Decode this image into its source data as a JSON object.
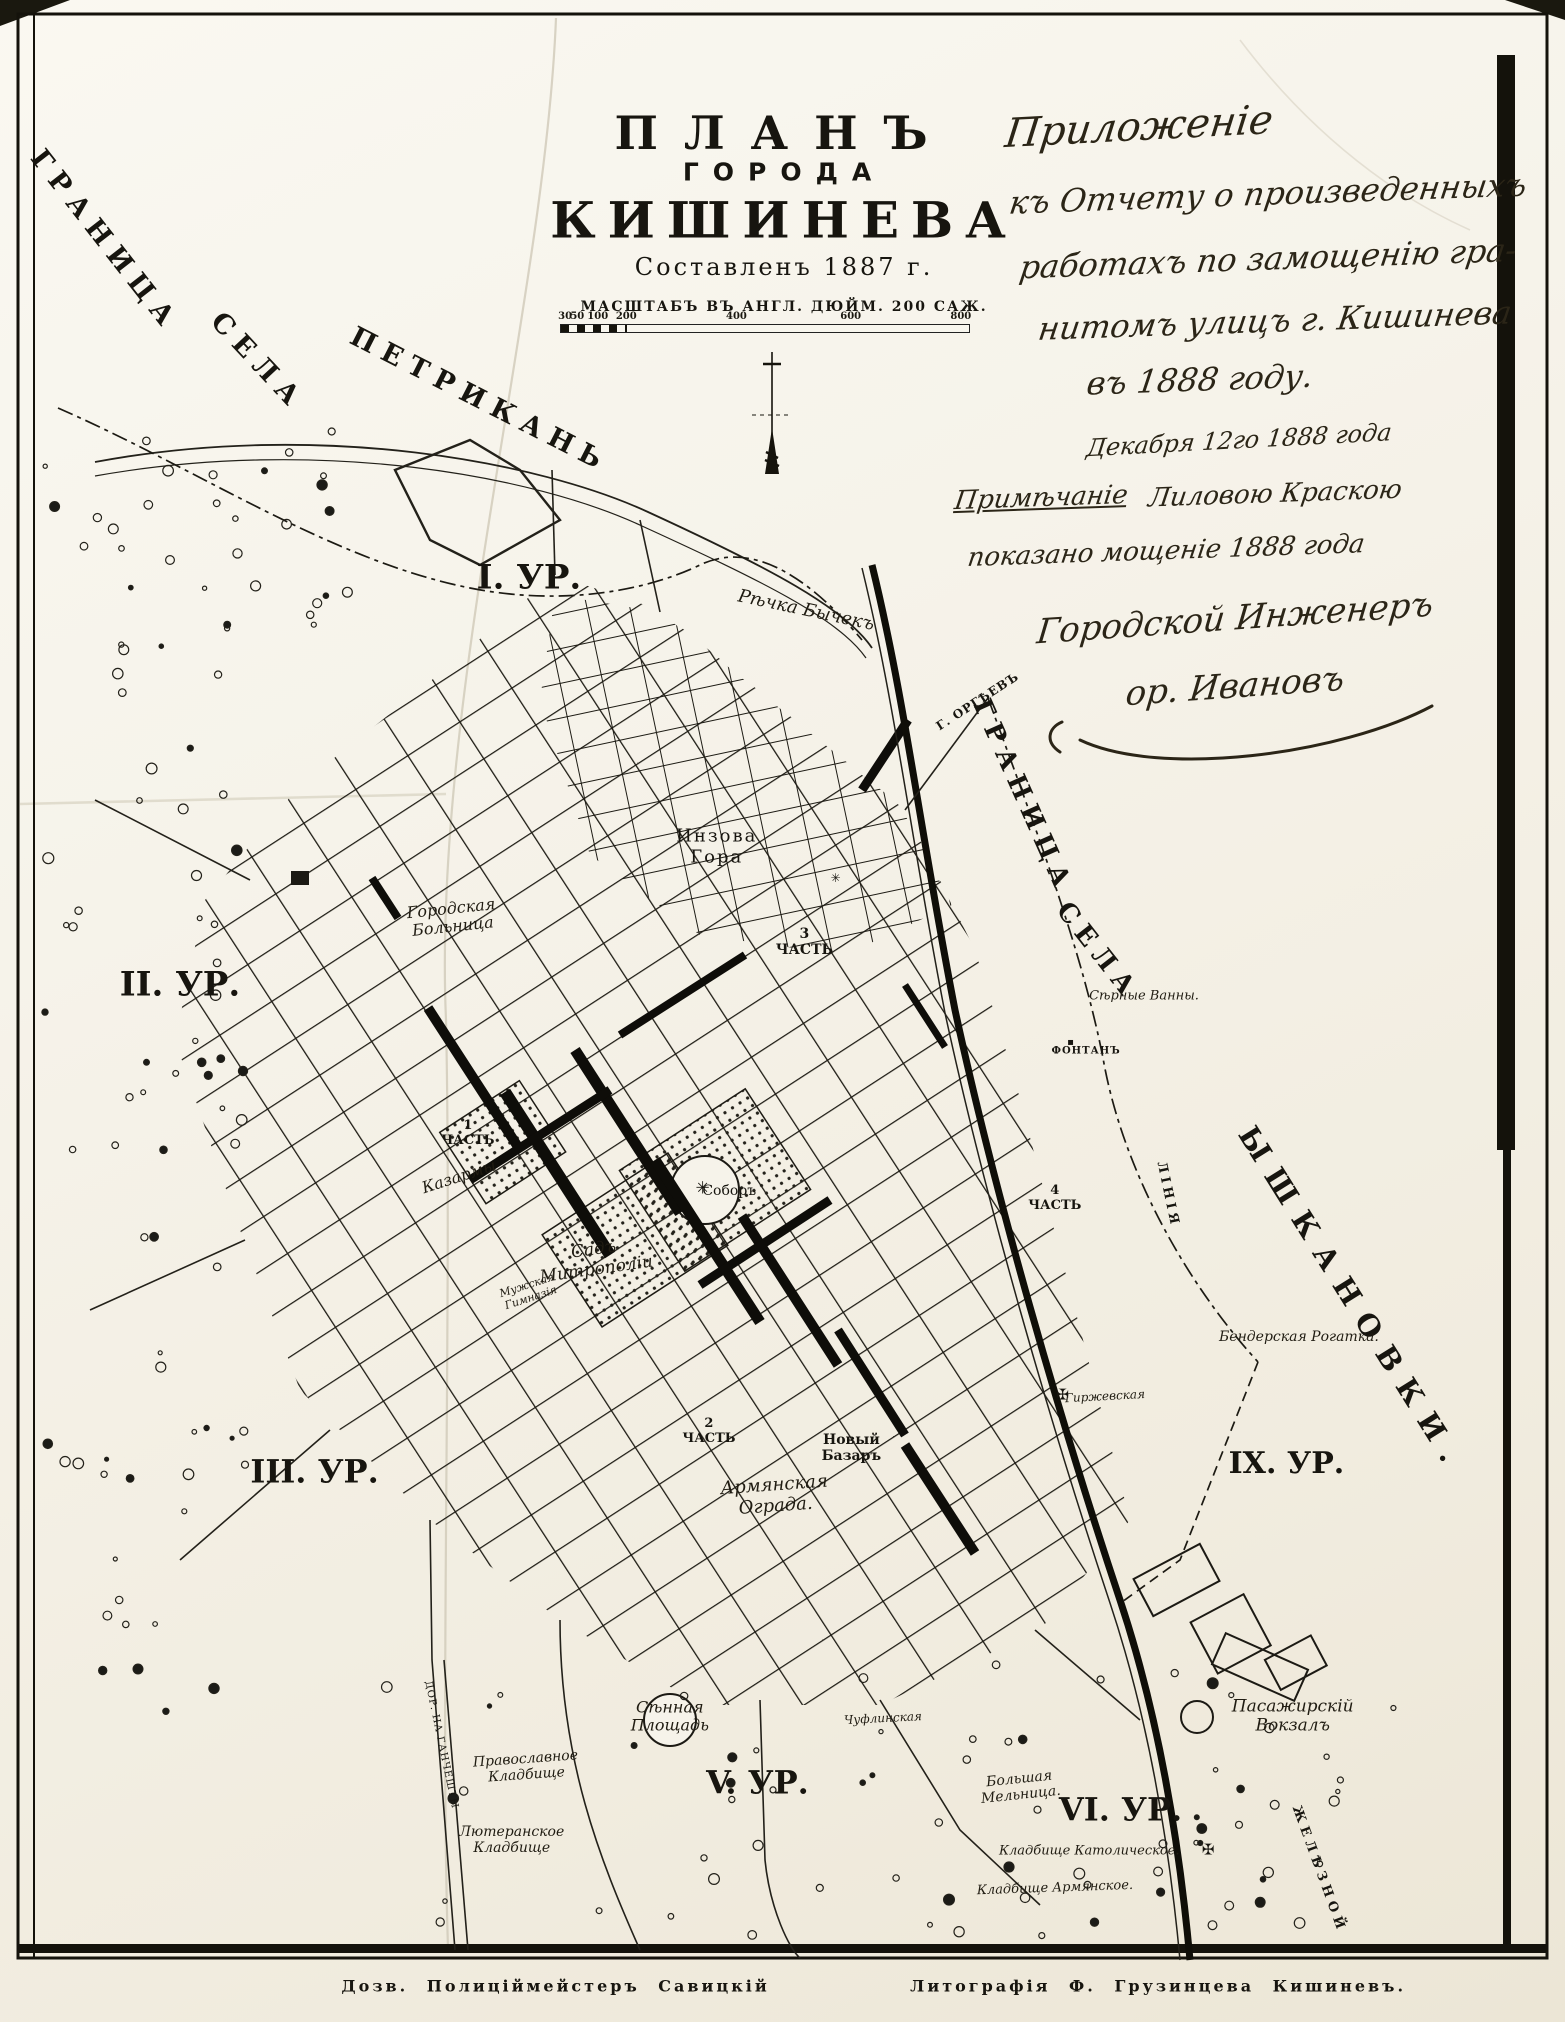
{
  "title_block": {
    "line1": "ПЛАНЪ",
    "line2": "ГОРОДА",
    "line3": "КИШИНЕВА",
    "line4": "Составленъ 1887 г.",
    "scale_text": "МАСШТАБЪ ВЪ АНГЛ. ДЮЙМ. 200 САЖ.",
    "scale_ticks": [
      {
        "t": "30",
        "f": 1
      },
      {
        "t": "50",
        "f": 4
      },
      {
        "t": "100",
        "f": 9
      },
      {
        "t": "200",
        "f": 16
      },
      {
        "t": "400",
        "f": 43
      },
      {
        "t": "600",
        "f": 71
      },
      {
        "t": "800",
        "f": 98
      }
    ]
  },
  "annotation": {
    "lines": [
      {
        "name": "hw-prilozhenie",
        "text": "Приложеніе",
        "x": 72.8,
        "y": 6.3,
        "fs": 40,
        "rot": -3
      },
      {
        "name": "hw-k-otchetu",
        "text": "къ Отчету о произведенныхъ",
        "x": 81.0,
        "y": 9.6,
        "fs": 32,
        "rot": -2
      },
      {
        "name": "hw-rabotakh",
        "text": "работахъ по замощенію гра-",
        "x": 81.0,
        "y": 12.8,
        "fs": 32,
        "rot": -2
      },
      {
        "name": "hw-nitom",
        "text": "нитомъ улицъ г. Кишинева",
        "x": 81.5,
        "y": 15.9,
        "fs": 32,
        "rot": -2
      },
      {
        "name": "hw-v-1888",
        "text": "въ 1888 году.",
        "x": 76.7,
        "y": 18.8,
        "fs": 32,
        "rot": -2
      },
      {
        "name": "hw-date",
        "text": "Декабря 12го 1888 года",
        "x": 79.2,
        "y": 21.8,
        "fs": 24,
        "rot": -3
      },
      {
        "name": "hw-primechanie",
        "text": "Примѣчаніе",
        "x": 66.5,
        "y": 24.7,
        "fs": 26,
        "rot": -2,
        "u": true
      },
      {
        "name": "hw-lilovoyu",
        "text": "Лиловою Краскою",
        "x": 81.5,
        "y": 24.5,
        "fs": 26,
        "rot": -2
      },
      {
        "name": "hw-pokazano",
        "text": "показано мощеніе 1888 года",
        "x": 74.5,
        "y": 27.3,
        "fs": 26,
        "rot": -2
      },
      {
        "name": "hw-gorodskoy-inzhener",
        "text": "Городской Инженеръ",
        "x": 78.9,
        "y": 30.6,
        "fs": 34,
        "rot": -4
      },
      {
        "name": "hw-signature",
        "text": "ор. Ивановъ",
        "x": 78.9,
        "y": 34.0,
        "fs": 34,
        "rot": -4
      }
    ]
  },
  "map": {
    "labels": [
      {
        "name": "label-granitsa-petrikan-1",
        "text": "ГРАНИЦА",
        "x": 6.7,
        "y": 11.9,
        "rot": 52,
        "fs": 27,
        "ls": 9,
        "b": true
      },
      {
        "name": "label-granitsa-petrikan-2",
        "text": "СЕЛА",
        "x": 16.5,
        "y": 17.9,
        "rot": 47,
        "fs": 27,
        "ls": 9,
        "b": true
      },
      {
        "name": "label-granitsa-petrikan-3",
        "text": "ПЕТРИКАНЬ",
        "x": 30.7,
        "y": 19.8,
        "rot": 27,
        "fs": 27,
        "ls": 9,
        "b": true
      },
      {
        "name": "label-granitsa-sela-1",
        "text": "ГРАНИЦА",
        "x": 65.3,
        "y": 39.4,
        "rot": 66,
        "fs": 26,
        "ls": 8,
        "b": true
      },
      {
        "name": "label-granitsa-sela-2",
        "text": "СЕЛА",
        "x": 70.1,
        "y": 47.1,
        "rot": 52,
        "fs": 26,
        "ls": 8,
        "b": true
      },
      {
        "name": "label-yshkanovki",
        "text": "ЫШКАНОВКИ.",
        "x": 86.4,
        "y": 64.3,
        "rot": 58,
        "fs": 29,
        "ls": 14,
        "b": true
      },
      {
        "name": "label-rechka-bychek",
        "text": "Рѣчка Бычекъ",
        "x": 51.5,
        "y": 30.2,
        "rot": 12,
        "fs": 18,
        "i": true
      },
      {
        "name": "label-g-orgeyev",
        "text": "Г. ОРГѢЕВЪ",
        "x": 62.5,
        "y": 34.7,
        "rot": -33,
        "fs": 12,
        "ls": 1,
        "b": true
      },
      {
        "name": "label-district-1",
        "text": "I. УР.",
        "x": 33.8,
        "y": 28.6,
        "fs": 34,
        "b": true
      },
      {
        "name": "label-district-2",
        "text": "II. УР.",
        "x": 11.5,
        "y": 48.7,
        "fs": 34,
        "b": true
      },
      {
        "name": "label-district-3",
        "text": "III. УР.",
        "x": 20.1,
        "y": 72.8,
        "fs": 32,
        "b": true
      },
      {
        "name": "label-district-5",
        "text": "V. УР.",
        "x": 48.4,
        "y": 88.2,
        "fs": 32,
        "b": true
      },
      {
        "name": "label-district-6",
        "text": "VI. УР.",
        "x": 71.6,
        "y": 89.5,
        "fs": 32,
        "b": true
      },
      {
        "name": "label-district-9",
        "text": "IX. УР.",
        "x": 82.2,
        "y": 72.4,
        "fs": 30,
        "b": true
      },
      {
        "name": "label-inzova-gora",
        "text": "Инзова\nГора",
        "x": 45.8,
        "y": 41.9,
        "fs": 18,
        "ls": 2
      },
      {
        "name": "label-3-chast",
        "text": "3\nЧАСТЬ",
        "x": 51.4,
        "y": 46.6,
        "fs": 14,
        "b": true
      },
      {
        "name": "label-1-chast",
        "text": "1\nЧАСТЬ",
        "x": 29.9,
        "y": 56.1,
        "fs": 13,
        "b": true
      },
      {
        "name": "label-2-chast",
        "text": "2\nЧАСТЬ",
        "x": 45.3,
        "y": 70.8,
        "fs": 13,
        "b": true
      },
      {
        "name": "label-4-chast",
        "text": "4\nЧАСТЬ",
        "x": 67.4,
        "y": 59.3,
        "fs": 13,
        "b": true
      },
      {
        "name": "label-gorodskaya-bolnitsa",
        "text": "Городская\nБольница",
        "x": 28.9,
        "y": 45.4,
        "rot": -6,
        "fs": 16,
        "i": true
      },
      {
        "name": "label-kazarmy",
        "text": "Казармы",
        "x": 29.3,
        "y": 58.2,
        "rot": -18,
        "fs": 16,
        "i": true
      },
      {
        "name": "label-sobor",
        "text": "Соборъ",
        "x": 46.6,
        "y": 58.9,
        "fs": 14
      },
      {
        "name": "label-sad-mitropolii",
        "text": "Садъ\nМитрополіи",
        "x": 38.0,
        "y": 62.3,
        "rot": -8,
        "fs": 17,
        "i": true
      },
      {
        "name": "label-muzhskaya-gimnaziya",
        "text": "Мужская\nГимназія",
        "x": 33.8,
        "y": 63.9,
        "rot": -18,
        "fs": 11,
        "i": true
      },
      {
        "name": "label-armyanskaya-ograda",
        "text": "Армянская\nОграда.",
        "x": 49.5,
        "y": 74.0,
        "rot": -4,
        "fs": 18,
        "i": true
      },
      {
        "name": "label-novy-bazar",
        "text": "Новый\nБазаръ",
        "x": 54.4,
        "y": 71.6,
        "fs": 14,
        "b": true
      },
      {
        "name": "label-syennaya-ploshchad",
        "text": "Сѣнная\nПлощадь",
        "x": 42.8,
        "y": 84.9,
        "fs": 16,
        "i": true
      },
      {
        "name": "label-pravoslavnoye-kladbishche",
        "text": "Православное\nКладбище",
        "x": 33.6,
        "y": 87.4,
        "rot": -4,
        "fs": 14,
        "i": true
      },
      {
        "name": "label-lyuteranskoye-kladbishche",
        "text": "Лютеранское\nКладбище",
        "x": 32.7,
        "y": 91.0,
        "fs": 14,
        "i": true
      },
      {
        "name": "label-kladbishche-katolicheskoye",
        "text": "Кладбище Католическое.",
        "x": 69.6,
        "y": 91.6,
        "fs": 13,
        "i": true
      },
      {
        "name": "label-kladbishche-armyanskoye",
        "text": "Кладбище Армянское.",
        "x": 67.4,
        "y": 93.4,
        "rot": -2,
        "fs": 13,
        "i": true
      },
      {
        "name": "label-bolshaya-melnitsa",
        "text": "Большая\nМельница.",
        "x": 65.2,
        "y": 88.4,
        "rot": -6,
        "fs": 14,
        "i": true
      },
      {
        "name": "label-pasazhirsky-vokzal",
        "text": "Пасажирскій\nВокзалъ",
        "x": 82.6,
        "y": 84.9,
        "fs": 17,
        "i": true
      },
      {
        "name": "label-syernye-vanny",
        "text": "Сѣрные Ванны.",
        "x": 73.1,
        "y": 49.3,
        "fs": 13,
        "i": true
      },
      {
        "name": "label-fontan",
        "text": "ФОНТАНЪ",
        "x": 69.4,
        "y": 52.0,
        "fs": 10,
        "ls": 1,
        "b": true
      },
      {
        "name": "label-benderskaya-rogatka",
        "text": "Бендерская Рогатка.",
        "x": 83.0,
        "y": 66.1,
        "fs": 14,
        "i": true
      },
      {
        "name": "label-liniya",
        "text": "ЛІНІЯ",
        "x": 74.6,
        "y": 59.1,
        "rot": 78,
        "fs": 13,
        "ls": 4,
        "b": true
      },
      {
        "name": "label-zheleznoy",
        "text": "ЖЕЛѢЗНОЙ",
        "x": 84.2,
        "y": 92.5,
        "rot": 70,
        "fs": 13,
        "ls": 5,
        "b": true
      },
      {
        "name": "label-chuflinskaya",
        "text": "Чуфлинская",
        "x": 56.4,
        "y": 85.0,
        "rot": -3,
        "fs": 12,
        "i": true
      },
      {
        "name": "label-girzhevskaya",
        "text": "Гиржевская",
        "x": 70.6,
        "y": 69.1,
        "rot": -3,
        "fs": 12,
        "i": true
      },
      {
        "name": "label-dor-na-gancheshty",
        "text": "ДОР. НА ГАНЧЕШТЫ",
        "x": 28.2,
        "y": 86.3,
        "rot": 78,
        "fs": 10,
        "ls": 1
      }
    ],
    "symbols": [
      {
        "name": "cathedral-star-icon",
        "text": "✳",
        "x": 44.9,
        "y": 58.8,
        "fs": 17
      },
      {
        "name": "girzhevskaya-cross-icon",
        "text": "✠",
        "x": 67.9,
        "y": 69.0,
        "fs": 15
      },
      {
        "name": "catholic-cemetery-cross-icon",
        "text": "✠",
        "x": 77.2,
        "y": 91.5,
        "fs": 15
      },
      {
        "name": "blagoveshchenskaya-cross-icon",
        "text": "✳",
        "x": 53.4,
        "y": 43.4,
        "fs": 12
      },
      {
        "name": "fountain-dot-icon",
        "text": "▪",
        "x": 68.4,
        "y": 51.6,
        "fs": 10
      }
    ]
  },
  "footer": {
    "left": "Дозв. Полиціймейстеръ  Савицкій",
    "right": "Литографія Ф. Грузинцева  Кишиневъ."
  }
}
